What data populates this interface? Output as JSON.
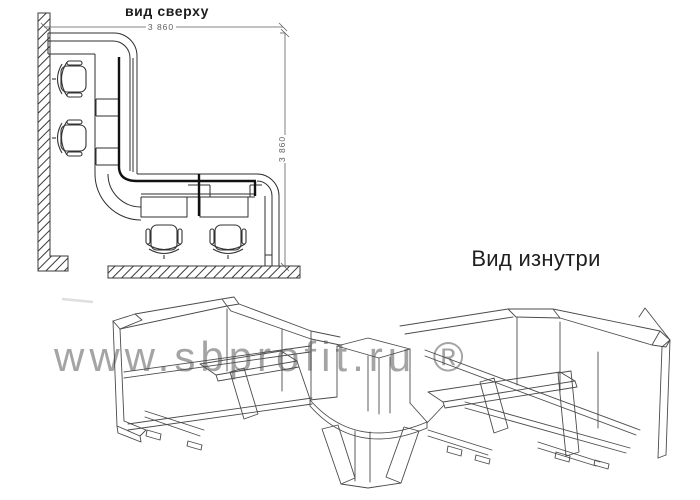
{
  "plan_view": {
    "title": "вид сверху",
    "width_dimension": "3 860",
    "height_dimension": "3 860"
  },
  "inside_view": {
    "title": "Вид изнутри"
  },
  "watermark": {
    "text": "www.sbprofit.ru ®"
  },
  "colors": {
    "background": "#ffffff",
    "line": "#4b4b4b",
    "plan_line": "#2f2f2f",
    "dimension": "#5f5f5f",
    "watermark": "#8a8a8a"
  }
}
